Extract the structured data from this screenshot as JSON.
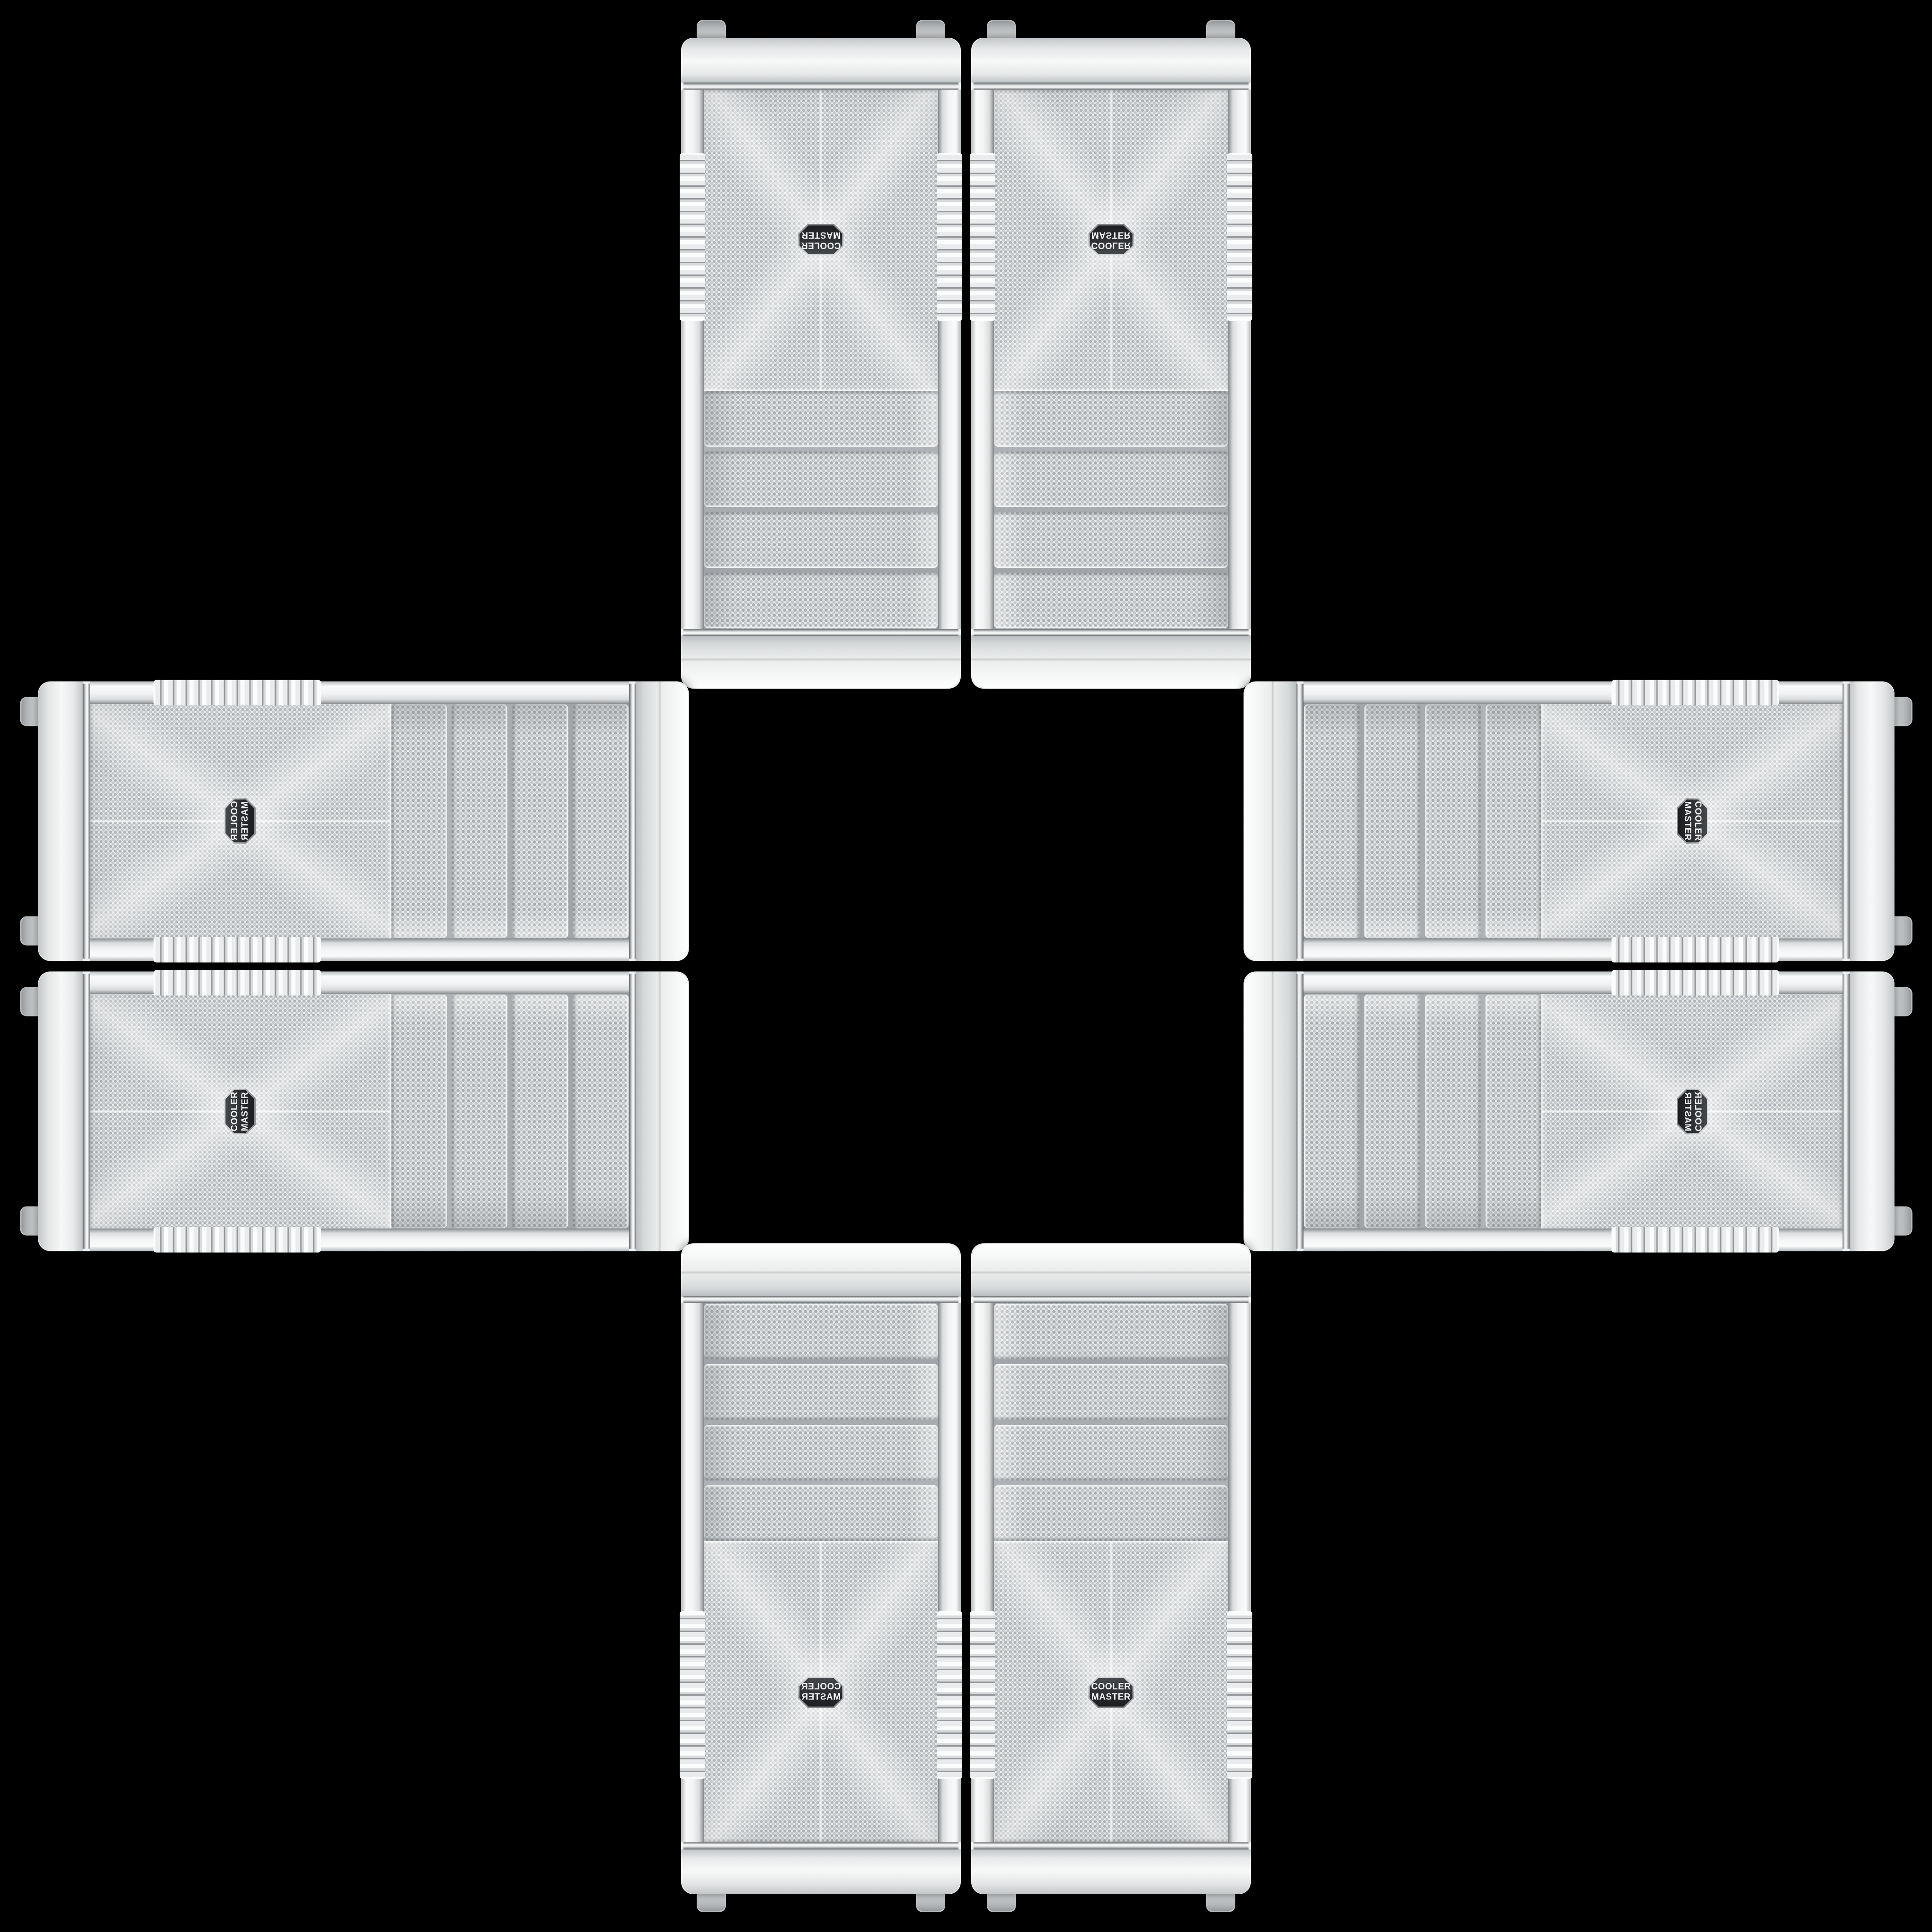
{
  "scene": {
    "description": "Eight identical white Cooler Master mid-tower PC cases, front panels facing the viewer, arranged in a plus / cross pattern on a black background with mirrored and rotated orientations",
    "background_color": "#000000",
    "case_count": 8,
    "arrangement": "plus-cross"
  },
  "case": {
    "brand": "Cooler Master",
    "logo_line1": "COOLER",
    "logo_line2": "MASTER",
    "drive_bay_count": 4,
    "body_color": "#eef0f1",
    "mesh_dot_color": "#b3b7ba",
    "trim_color": "#c9cccd",
    "badge_face_color": "#2b2d30",
    "badge_rim_color": "#c2c5c7",
    "badge_text_color": "#f1f2f3"
  },
  "cases": [
    {
      "id": "top-left",
      "orientation": "rotated-180",
      "badge_flip": false
    },
    {
      "id": "top-right",
      "orientation": "flipped-vertical",
      "badge_flip": false
    },
    {
      "id": "left-upper",
      "orientation": "rotated-90-mirrored",
      "badge_flip": true
    },
    {
      "id": "right-upper",
      "orientation": "rotated-90-ccw",
      "badge_flip": true
    },
    {
      "id": "left-lower",
      "orientation": "rotated-90-cw",
      "badge_flip": true
    },
    {
      "id": "right-lower",
      "orientation": "rotated-90-ccw-flipped",
      "badge_flip": true
    },
    {
      "id": "bottom-left",
      "orientation": "mirrored-horizontal",
      "badge_flip": false
    },
    {
      "id": "bottom-right",
      "orientation": "upright",
      "badge_flip": false
    }
  ]
}
